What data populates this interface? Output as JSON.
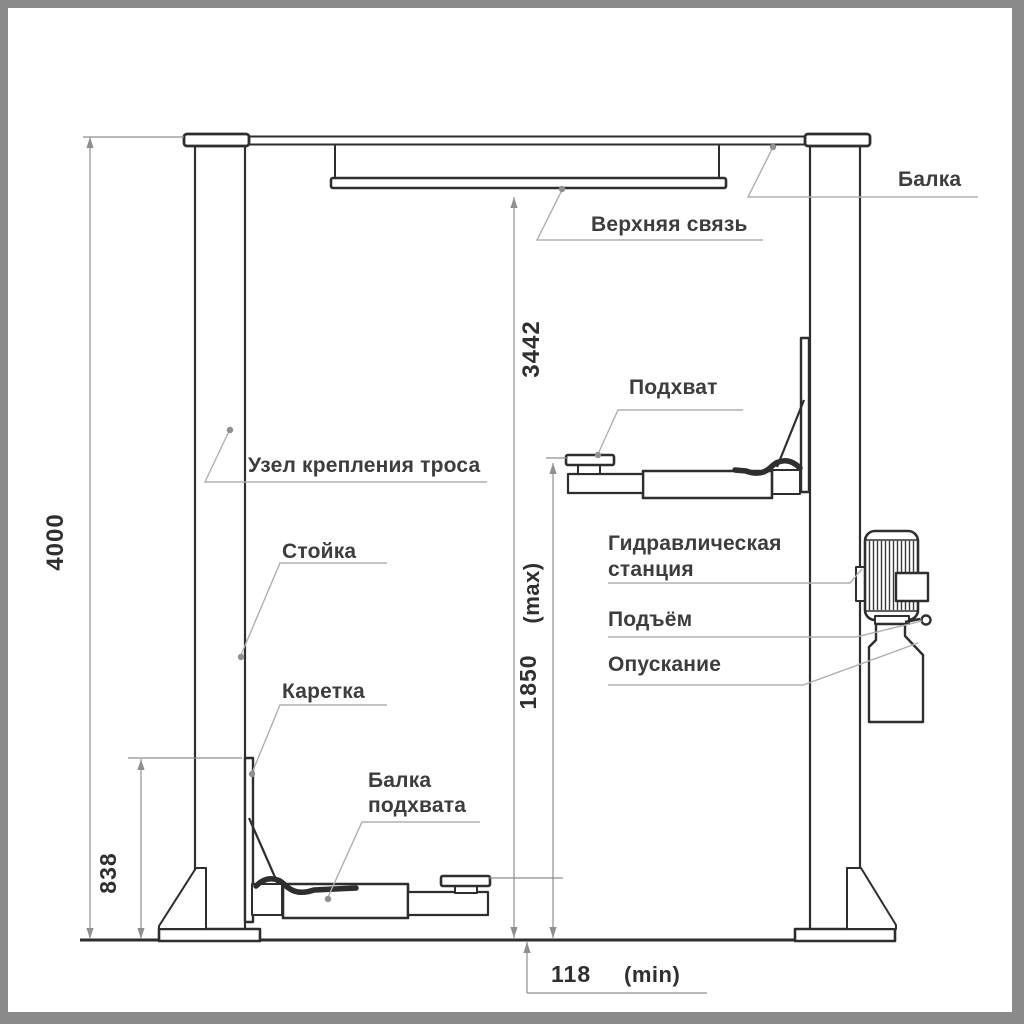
{
  "drawing": {
    "labels": {
      "beam": "Балка",
      "upper_tie": "Верхняя связь",
      "pickup_pad": "Подхват",
      "cable_mount": "Узел крепления троса",
      "post": "Стойка",
      "hydraulic_line1": "Гидравлическая",
      "hydraulic_line2": "станция",
      "raise": "Подъём",
      "carriage": "Каретка",
      "lowering": "Опускание",
      "pickup_beam_line1": "Балка",
      "pickup_beam_line2": "подхвата"
    },
    "dimensions": {
      "overall_height": "4000",
      "under_tie_height": "3442",
      "max_lift_height": "1850",
      "max_suffix": "(max)",
      "carriage_height": "838",
      "min_pad_height": "118",
      "min_suffix": "(min)"
    },
    "colors": {
      "frame": "#8a8a8a",
      "paper": "#ffffff",
      "ink": "#2e2e2e",
      "label_text": "#3d3d3d",
      "leader": "#b0b0b0",
      "dimension": "#8f8f8f"
    }
  }
}
